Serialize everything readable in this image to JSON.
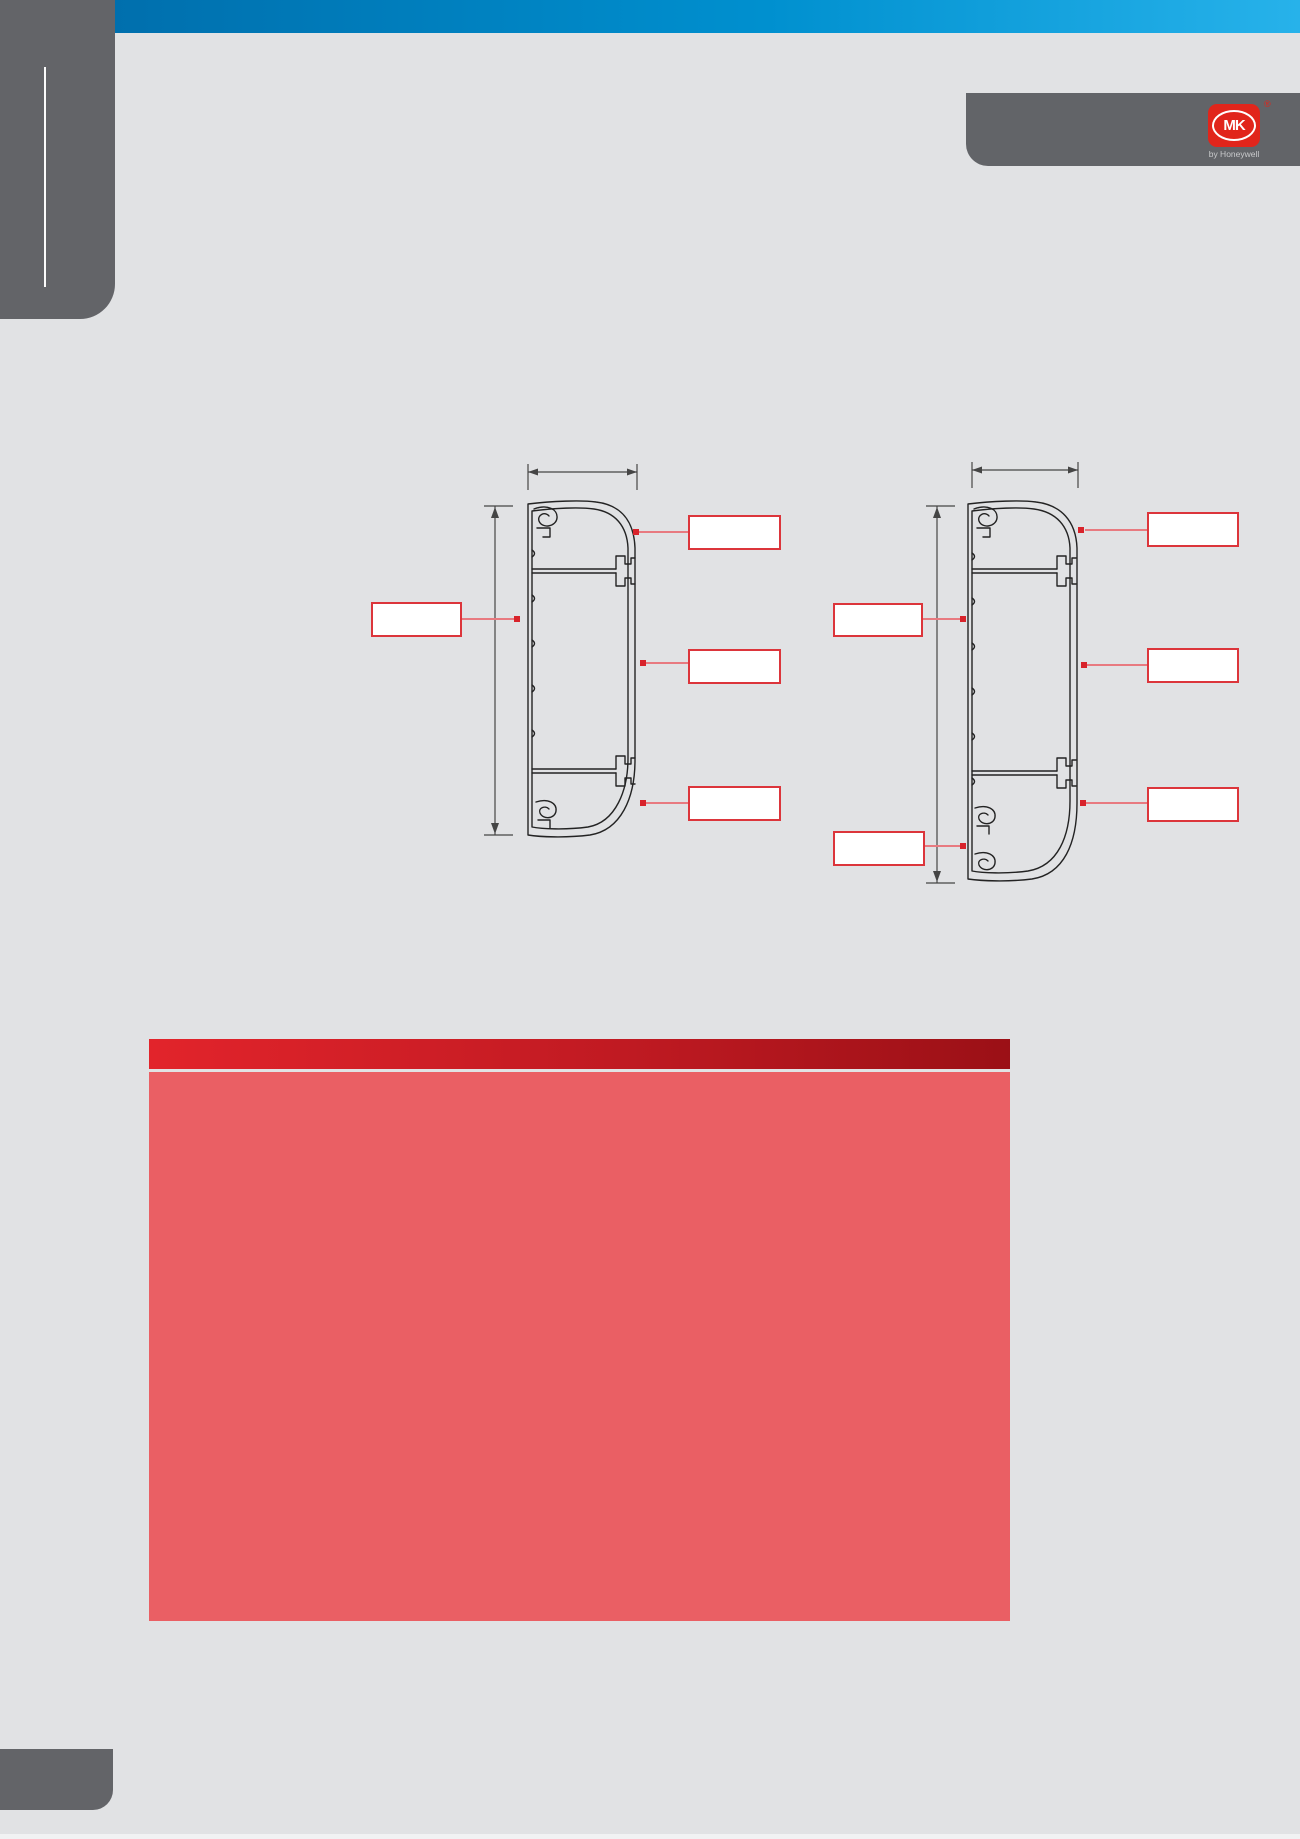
{
  "page": {
    "background": "#e1e2e4"
  },
  "header": {
    "bar_color_left": "#006fad",
    "bar_color_right": "#27b2ea"
  },
  "brand": {
    "logo_text": "MK",
    "registered_mark": "®",
    "byline": "by Honeywell",
    "logo_color": "#e1251b"
  },
  "diagram_left": {
    "callouts": {
      "side_label": "",
      "right_top_label": "",
      "right_middle_label": "",
      "right_bottom_label": ""
    }
  },
  "diagram_right": {
    "callouts": {
      "left_middle_label": "",
      "left_bottom_label": "",
      "right_top_label": "",
      "right_middle_label": "",
      "right_bottom_label": ""
    }
  },
  "table": {
    "title": "",
    "colors": {
      "bar_left": "#e2242b",
      "bar_right": "#9b1016",
      "grid_line": "#ea5f64",
      "header_gray": "#636569"
    },
    "header_cells": [
      "",
      "",
      "",
      "",
      "",
      ""
    ],
    "sub_rows": [
      [
        "",
        "",
        ""
      ],
      [
        ""
      ],
      [
        "",
        "",
        ""
      ],
      [
        ""
      ],
      [
        "",
        "",
        ""
      ]
    ],
    "body_rows": [
      [
        "",
        ""
      ],
      [
        "",
        "",
        "",
        "",
        "",
        ""
      ],
      [
        "",
        "",
        "",
        "",
        "",
        ""
      ],
      [
        "",
        "",
        "",
        "",
        "",
        ""
      ],
      [
        "",
        "",
        "",
        "",
        "",
        ""
      ],
      [
        "",
        ""
      ],
      [
        "",
        "",
        "",
        "",
        "",
        ""
      ],
      [
        "",
        "",
        "",
        "",
        "",
        "",
        "",
        "",
        ""
      ],
      [
        "",
        "",
        "",
        "",
        "",
        "",
        "",
        "",
        ""
      ],
      [
        "",
        "",
        "",
        "",
        "",
        "",
        "",
        "",
        ""
      ],
      [
        "",
        "",
        "",
        "",
        "",
        "",
        "",
        "",
        ""
      ],
      [
        "",
        "",
        "",
        "",
        "",
        "",
        "",
        "",
        ""
      ]
    ]
  }
}
